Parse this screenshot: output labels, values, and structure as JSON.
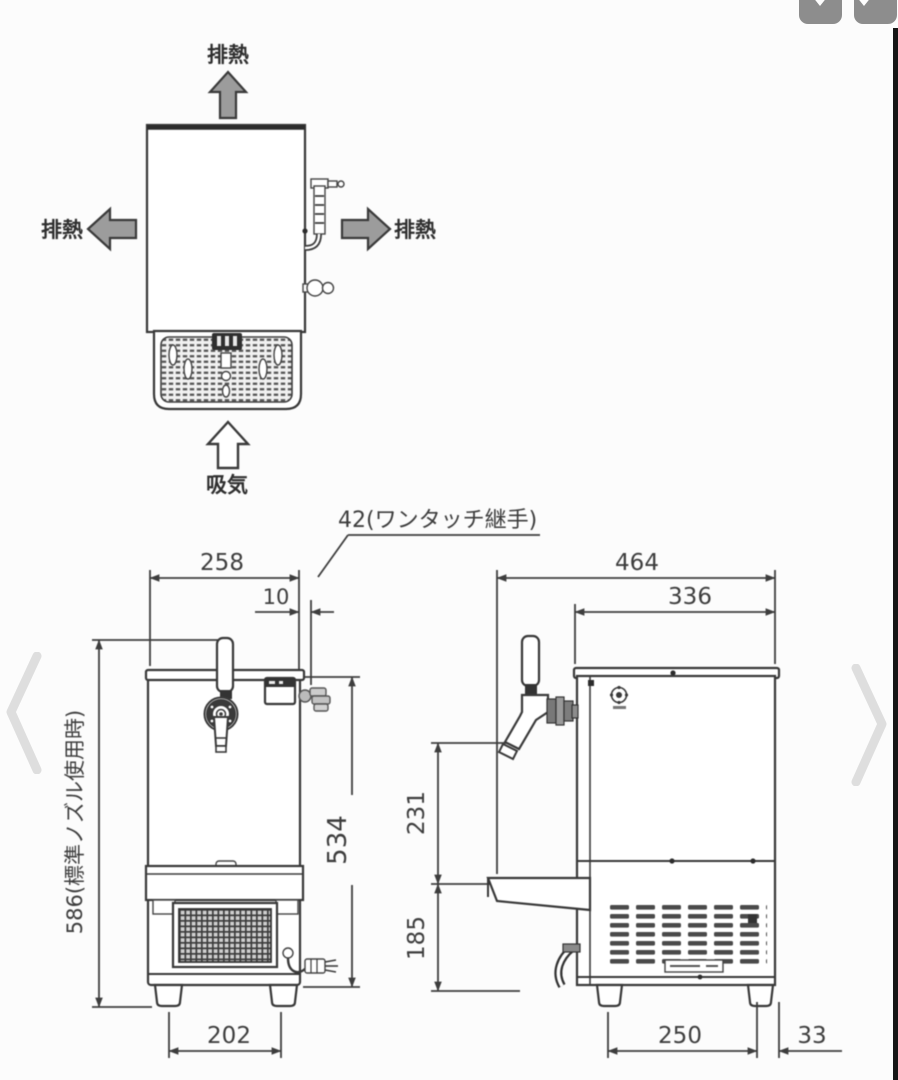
{
  "viewer": {
    "toolbar_button_1": "",
    "toolbar_button_2": "",
    "prev_arrow": "‹",
    "next_arrow": "›"
  },
  "colors": {
    "line": "#3d3d3d",
    "arrow_fill": "#9c9c9c",
    "ui_button": "#8d8d8d",
    "edge_bar": "#161616",
    "chevron": "#dedede"
  },
  "drawing": {
    "airflow": {
      "exhaust_top": "排熱",
      "exhaust_left": "排熱",
      "exhaust_right": "排熱",
      "intake": "吸気"
    },
    "callout_fitting": "42(ワンタッチ継手)",
    "front": {
      "dim_width": "258",
      "dim_fitting_offset": "10",
      "dim_body_height": "534",
      "dim_total_height": "586(標準ノズル使用時)",
      "dim_foot_span": "202"
    },
    "side": {
      "dim_depth": "464",
      "dim_body_depth": "336",
      "dim_tap_drop": "231",
      "dim_lower_height": "185",
      "dim_foot_span": "250",
      "dim_rear_offset": "33"
    }
  }
}
